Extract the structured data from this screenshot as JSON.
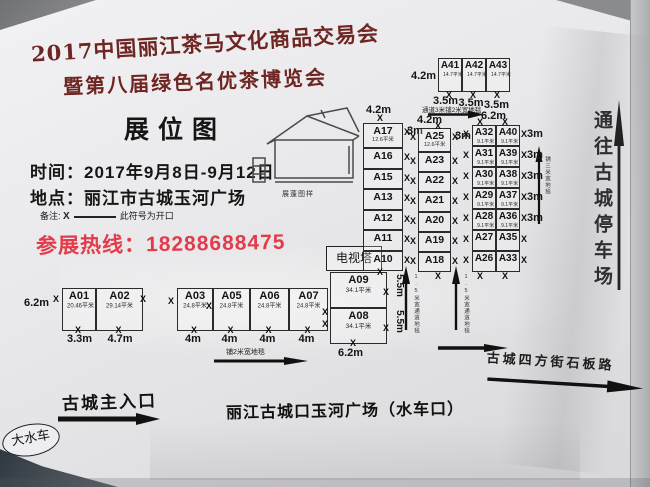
{
  "header": {
    "title_line1": "2017中国丽江茶马文化商品交易会",
    "title_line2": "暨第八届绿色名优茶博览会",
    "map_title": "展位图",
    "time_label": "时间：",
    "time_value": "2017年9月8日-9月12日",
    "place_label": "地点：",
    "place_value": "丽江市古城玉河广场",
    "note_label": "备注:",
    "note_text": "此符号为开口",
    "hotline": "参展热线：18288688475"
  },
  "annotations": {
    "open_marker": "X",
    "carpet_top": "通道3米铺2米宽地毯",
    "carpet_bottom": "铺2米宽地毯",
    "carpet_right": "铺三米宽地毯",
    "aisle_carpet": "1.5米宽通道地毯"
  },
  "landmarks": {
    "tent_label": "展蓬图样",
    "tv_tower": "电视塔",
    "main_entrance": "古城主入口",
    "plaza": "丽江古城口玉河广场（水车口）",
    "waterwheel": "大水车",
    "parking": "通往古城停车场",
    "stone_road": "古城四方街石板路"
  },
  "booths": {
    "block1": {
      "height_label": "6.2m",
      "cells": [
        {
          "id": "A01",
          "area": "20.46平米",
          "width": "3.3m"
        },
        {
          "id": "A02",
          "area": "29.14平米",
          "width": "4.7m"
        }
      ]
    },
    "block2": {
      "cells": [
        {
          "id": "A03",
          "area": "24.8平米",
          "width": "4m"
        },
        {
          "id": "A05",
          "area": "24.8平米",
          "width": "4m"
        },
        {
          "id": "A06",
          "area": "24.8平米",
          "width": "4m"
        },
        {
          "id": "A07",
          "area": "24.8平米",
          "width": "4m"
        }
      ]
    },
    "block3": {
      "width_label": "6.2m",
      "cells": [
        {
          "id": "A09",
          "area": "34.1平米",
          "side": "5.5m"
        },
        {
          "id": "A08",
          "area": "34.1平米",
          "side": "5.5m"
        }
      ]
    },
    "col1": {
      "top_label": "4.2m",
      "aisle_label": "3m",
      "cells": [
        {
          "id": "A17",
          "area": "12.6平米"
        },
        {
          "id": "A16"
        },
        {
          "id": "A15"
        },
        {
          "id": "A13"
        },
        {
          "id": "A12"
        },
        {
          "id": "A11"
        },
        {
          "id": "A10"
        }
      ]
    },
    "col2": {
      "top_label": "4.2m",
      "aisle_label": "3m",
      "cells": [
        {
          "id": "A25",
          "area": "12.6平米"
        },
        {
          "id": "A23"
        },
        {
          "id": "A22"
        },
        {
          "id": "A21"
        },
        {
          "id": "A20"
        },
        {
          "id": "A19"
        },
        {
          "id": "A18"
        }
      ]
    },
    "col3": {
      "top_label": "6.2m",
      "row_label": "3m",
      "rows": [
        [
          {
            "id": "A32",
            "area": "9.1平米"
          },
          {
            "id": "A40",
            "area": "9.1平米"
          }
        ],
        [
          {
            "id": "A31",
            "area": "9.1平米"
          },
          {
            "id": "A39",
            "area": "9.1平米"
          }
        ],
        [
          {
            "id": "A30",
            "area": "9.1平米"
          },
          {
            "id": "A38",
            "area": "9.1平米"
          }
        ],
        [
          {
            "id": "A29",
            "area": "9.1平米"
          },
          {
            "id": "A37",
            "area": "9.1平米"
          }
        ],
        [
          {
            "id": "A28",
            "area": "9.1平米"
          },
          {
            "id": "A36",
            "area": "9.1平米"
          }
        ],
        [
          {
            "id": "A27"
          },
          {
            "id": "A35"
          }
        ],
        [
          {
            "id": "A26"
          },
          {
            "id": "A33"
          }
        ]
      ]
    },
    "toprow": {
      "left_label": "4.2m",
      "cells": [
        {
          "id": "A41",
          "area": "14.7平米",
          "width": "3.5m"
        },
        {
          "id": "A42",
          "area": "14.7平米",
          "width": "3.5m"
        },
        {
          "id": "A43",
          "area": "14.7平米",
          "width": "3.5m"
        }
      ]
    }
  }
}
